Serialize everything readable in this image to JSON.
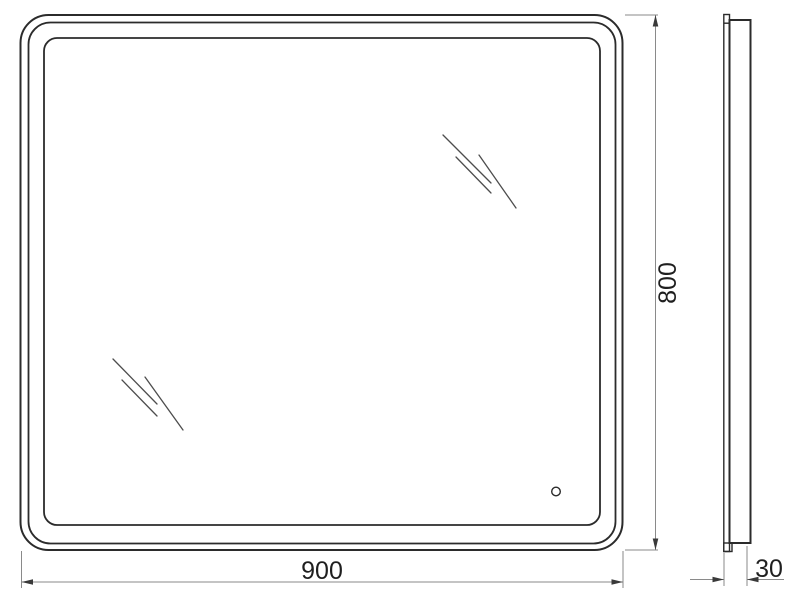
{
  "colors": {
    "background": "#ffffff",
    "frame-line": "#2b2b2b",
    "dim-line": "#8a8a8a",
    "arrow": "#3a3a3a",
    "text": "#1f1f1f",
    "shine": "#4d4d4d"
  },
  "dimensions": {
    "width": {
      "value": "900"
    },
    "height": {
      "value": "800"
    },
    "depth": {
      "value": "30"
    }
  }
}
